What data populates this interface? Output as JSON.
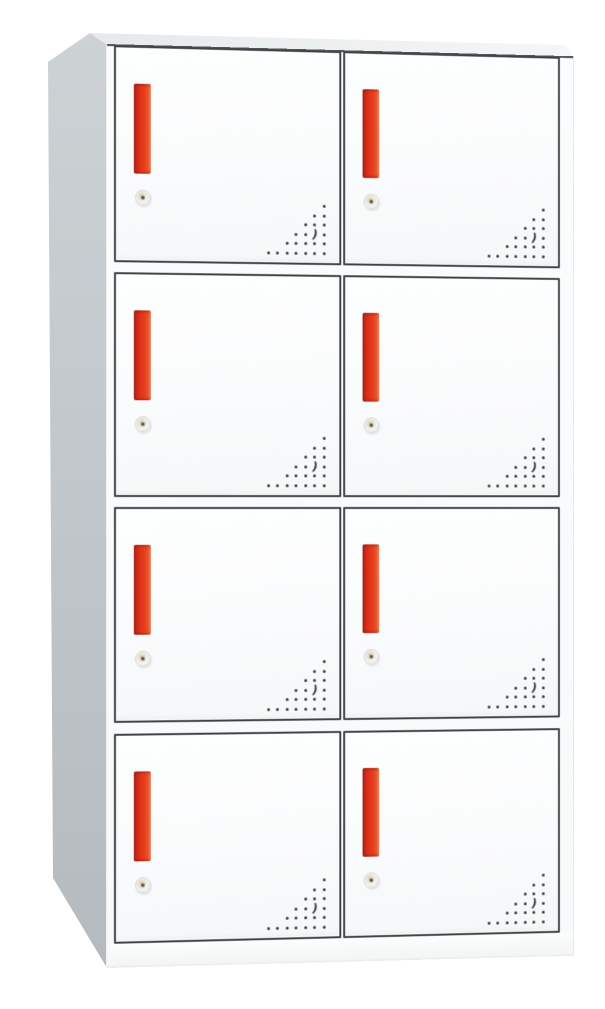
{
  "scene": {
    "type": "product-photo",
    "subject": "8-door metal locker cabinet",
    "background_color": "#ffffff",
    "view": "front with left side and top visible in slight perspective"
  },
  "cabinet": {
    "rows": 4,
    "columns": 2,
    "door_count": 8,
    "doors": [
      {
        "id": "door-r1-c1",
        "row": 1,
        "col": 1
      },
      {
        "id": "door-r1-c2",
        "row": 1,
        "col": 2
      },
      {
        "id": "door-r2-c1",
        "row": 2,
        "col": 1
      },
      {
        "id": "door-r2-c2",
        "row": 2,
        "col": 2
      },
      {
        "id": "door-r3-c1",
        "row": 3,
        "col": 1
      },
      {
        "id": "door-r3-c2",
        "row": 3,
        "col": 2
      },
      {
        "id": "door-r4-c1",
        "row": 4,
        "col": 1
      },
      {
        "id": "door-r4-c2",
        "row": 4,
        "col": 2
      }
    ],
    "colors": {
      "door_face": "#fbfcfd",
      "door_outline": "#3f4347",
      "side_panel_top": "#cdd2d5",
      "side_panel_bottom": "#b7bdc1",
      "top_panel": "#eef0f2",
      "handle_red_dark": "#9e1d13",
      "handle_red_main": "#e63d1e",
      "handle_red_light": "#ef7c4a",
      "lock_body": "#e5dfcd",
      "vent_dot": "#363b3f"
    },
    "handle": {
      "shape": "vertical-bar",
      "per_door": 1
    },
    "lock": {
      "shape": "round-cam-lock",
      "per_door": 1
    },
    "perforation": {
      "position": "bottom-right of each door",
      "pattern": "right-aligned triangle of drilled dots",
      "rows_dots": [
        1,
        2,
        3,
        4,
        5,
        7
      ],
      "crescent_row_index": 3,
      "crescent_offset_from_right": 1,
      "crescent_glyph": ")"
    }
  }
}
